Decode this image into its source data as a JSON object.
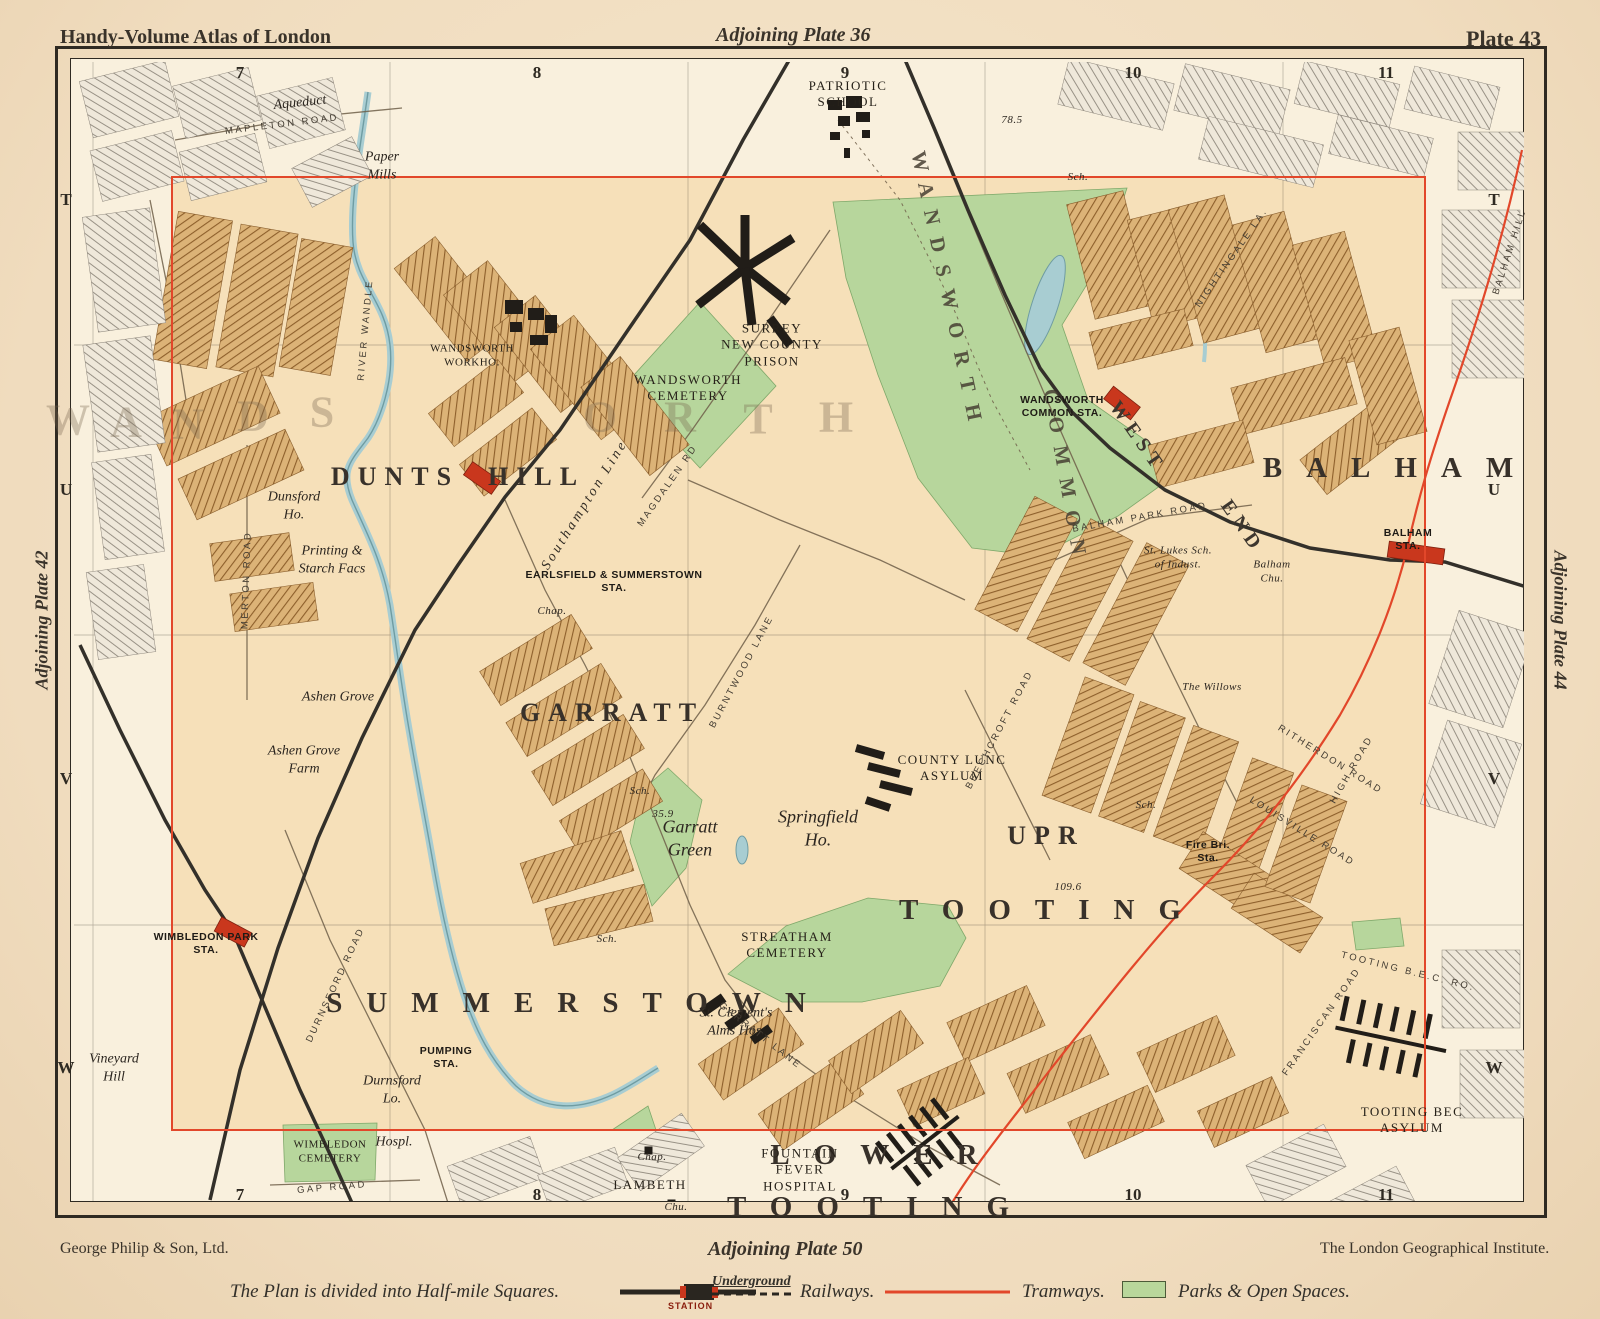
{
  "header": {
    "left": "Handy-Volume Atlas of London",
    "center": "Adjoining Plate 36",
    "right": "Plate 43"
  },
  "margins": {
    "left_vertical": "Adjoining Plate 42",
    "right_vertical": "Adjoining Plate 44",
    "bottom_center": "Adjoining Plate 50"
  },
  "footer": {
    "left": "George Philip & Son, Ltd.",
    "right": "The London Geographical Institute."
  },
  "grid": {
    "columns": [
      "7",
      "8",
      "9",
      "10",
      "11"
    ],
    "rows": [
      "T",
      "U",
      "V",
      "W"
    ]
  },
  "legend": {
    "intro": "The Plan is divided into Half-mile Squares.",
    "station_label": "STATION",
    "underground_label": "Underground",
    "railways_label": "Railways.",
    "tramways_label": "Tramways.",
    "parks_label": "Parks & Open Spaces."
  },
  "colors": {
    "plate_border": "#e2472a",
    "tramway": "#e2472a",
    "railway": "#33302a",
    "park_green": "#b7d69c",
    "water_blue": "#a8cdd2",
    "station_red": "#c9371d",
    "paper": "#f2e0c5"
  },
  "map": {
    "labels": [
      {
        "t": "DUNTS  HILL",
        "x": 458,
        "y": 477,
        "c": "district"
      },
      {
        "t": "GARRATT",
        "x": 612,
        "y": 713,
        "c": "district"
      },
      {
        "t": "SUMMERSTOWN",
        "x": 578,
        "y": 1003,
        "c": "district-wide"
      },
      {
        "t": "UPR",
        "x": 1046,
        "y": 836,
        "c": "district"
      },
      {
        "t": "TOOTING",
        "x": 1052,
        "y": 910,
        "c": "district-wide"
      },
      {
        "t": "LOWER",
        "x": 886,
        "y": 1155,
        "c": "district-wide"
      },
      {
        "t": "TOOTING",
        "x": 880,
        "y": 1207,
        "c": "district-wide"
      },
      {
        "t": "BALHAM",
        "x": 1400,
        "y": 468,
        "c": "district-wide"
      },
      {
        "t": "WEST",
        "x": 1137,
        "y": 437,
        "c": "district-sm",
        "r": 55
      },
      {
        "t": "END",
        "x": 1242,
        "y": 527,
        "c": "district-sm",
        "r": 55
      },
      {
        "t": "WANDSWORTH",
        "x": 948,
        "y": 292,
        "c": "rail-name",
        "r": 78
      },
      {
        "t": "COMMON",
        "x": 1066,
        "y": 478,
        "c": "rail-name",
        "r": 80
      },
      {
        "t": "W",
        "x": 68,
        "y": 420,
        "c": "faint"
      },
      {
        "t": "A",
        "x": 126,
        "y": 422,
        "c": "faint"
      },
      {
        "t": "N",
        "x": 188,
        "y": 424,
        "c": "faint"
      },
      {
        "t": "D",
        "x": 253,
        "y": 416,
        "c": "faint"
      },
      {
        "t": "S",
        "x": 322,
        "y": 412,
        "c": "faint"
      },
      {
        "t": "O",
        "x": 600,
        "y": 417,
        "c": "faint"
      },
      {
        "t": "R",
        "x": 680,
        "y": 417,
        "c": "faint"
      },
      {
        "t": "T",
        "x": 758,
        "y": 419,
        "c": "faint"
      },
      {
        "t": "H",
        "x": 836,
        "y": 417,
        "c": "faint"
      },
      {
        "t": "WANDSWORTH\nCEMETERY",
        "x": 688,
        "y": 388,
        "c": "place"
      },
      {
        "t": "SURREY\nNEW COUNTY\nPRISON",
        "x": 772,
        "y": 345,
        "c": "place"
      },
      {
        "t": "PATRIOTIC\nSCHOOL",
        "x": 848,
        "y": 94,
        "c": "place"
      },
      {
        "t": "COUNTY LUNC\nASYLUM",
        "x": 952,
        "y": 768,
        "c": "place"
      },
      {
        "t": "STREATHAM\nCEMETERY",
        "x": 787,
        "y": 945,
        "c": "place"
      },
      {
        "t": "TOOTING BEC\nASYLUM",
        "x": 1412,
        "y": 1120,
        "c": "place"
      },
      {
        "t": "WIMBLEDON\nCEMETERY",
        "x": 330,
        "y": 1152,
        "c": "place tiny2"
      },
      {
        "t": "FOUNTAIN\nFEVER\nHOSPITAL",
        "x": 800,
        "y": 1170,
        "c": "place"
      },
      {
        "t": "LAMBETH",
        "x": 650,
        "y": 1185,
        "c": "place"
      },
      {
        "t": "WANDSWORTH\nWORKHO.",
        "x": 472,
        "y": 356,
        "c": "place tiny2"
      },
      {
        "t": "St. Lukes Sch.\nof Indust.",
        "x": 1178,
        "y": 558,
        "c": "italic tiny2"
      },
      {
        "t": "Garratt\nGreen",
        "x": 690,
        "y": 838,
        "c": "italic big-it"
      },
      {
        "t": "Springfield\nHo.",
        "x": 818,
        "y": 828,
        "c": "italic big-it"
      },
      {
        "t": "Dunsford\nHo.",
        "x": 294,
        "y": 506,
        "c": "italic"
      },
      {
        "t": "Ashen Grove",
        "x": 338,
        "y": 697,
        "c": "italic"
      },
      {
        "t": "Ashen Grove\nFarm",
        "x": 304,
        "y": 760,
        "c": "italic"
      },
      {
        "t": "Printing &\nStarch Facs",
        "x": 332,
        "y": 560,
        "c": "italic"
      },
      {
        "t": "Durnsford\nLo.",
        "x": 392,
        "y": 1090,
        "c": "italic"
      },
      {
        "t": "Vineyard\nHill",
        "x": 114,
        "y": 1068,
        "c": "italic"
      },
      {
        "t": "Paper\nMills",
        "x": 382,
        "y": 166,
        "c": "italic"
      },
      {
        "t": "Aqueduct",
        "x": 300,
        "y": 103,
        "c": "italic",
        "r": -6
      },
      {
        "t": "Hospl.",
        "x": 394,
        "y": 1142,
        "c": "italic"
      },
      {
        "t": "Chap.",
        "x": 652,
        "y": 1158,
        "c": "italic tiny2"
      },
      {
        "t": "Chu.",
        "x": 676,
        "y": 1208,
        "c": "italic tiny2"
      },
      {
        "t": "Chap.",
        "x": 552,
        "y": 612,
        "c": "italic tiny2"
      },
      {
        "t": "St. Clement's\nAlms Hos.",
        "x": 736,
        "y": 1022,
        "c": "italic"
      },
      {
        "t": "The Willows",
        "x": 1212,
        "y": 688,
        "c": "italic tiny2"
      },
      {
        "t": "Fire Bri.\nSta.",
        "x": 1208,
        "y": 852,
        "c": "station tiny2"
      },
      {
        "t": "Balham\nChu.",
        "x": 1272,
        "y": 572,
        "c": "italic tiny2"
      },
      {
        "t": "109.6",
        "x": 1068,
        "y": 888,
        "c": "italic tiny2"
      },
      {
        "t": "78.5",
        "x": 1012,
        "y": 121,
        "c": "italic tiny2"
      },
      {
        "t": "35.9",
        "x": 663,
        "y": 815,
        "c": "italic tiny2"
      },
      {
        "t": "Sch.",
        "x": 640,
        "y": 792,
        "c": "italic tiny2"
      },
      {
        "t": "Sch.",
        "x": 607,
        "y": 940,
        "c": "italic tiny2"
      },
      {
        "t": "Sch.",
        "x": 1078,
        "y": 178,
        "c": "italic tiny2"
      },
      {
        "t": "Sch.",
        "x": 1146,
        "y": 806,
        "c": "italic tiny2"
      },
      {
        "t": "EARLSFIELD & SUMMERSTOWN\nSTA.",
        "x": 614,
        "y": 582,
        "c": "station"
      },
      {
        "t": "WANDSWORTH\nCOMMON STA.",
        "x": 1062,
        "y": 407,
        "c": "station"
      },
      {
        "t": "BALHAM\nSTA.",
        "x": 1408,
        "y": 540,
        "c": "station"
      },
      {
        "t": "WIMBLEDON PARK\nSTA.",
        "x": 206,
        "y": 944,
        "c": "station"
      },
      {
        "t": "PUMPING\nSTA.",
        "x": 446,
        "y": 1058,
        "c": "station"
      },
      {
        "t": "Southampton Line",
        "x": 585,
        "y": 505,
        "c": "rail-label",
        "r": -58
      },
      {
        "t": "RIVER WANDLE",
        "x": 366,
        "y": 330,
        "c": "road",
        "r": -85
      },
      {
        "t": "BURNTWOOD LANE",
        "x": 742,
        "y": 672,
        "c": "road",
        "r": -62
      },
      {
        "t": "GARRATT LANE",
        "x": 760,
        "y": 1036,
        "c": "road",
        "r": 38
      },
      {
        "t": "MERTON ROAD",
        "x": 247,
        "y": 580,
        "c": "road",
        "r": -88
      },
      {
        "t": "DURNSFORD ROAD",
        "x": 336,
        "y": 985,
        "c": "road",
        "r": -65
      },
      {
        "t": "GAP ROAD",
        "x": 332,
        "y": 1188,
        "c": "road",
        "r": -5
      },
      {
        "t": "BALHAM HILL",
        "x": 1510,
        "y": 252,
        "c": "road",
        "r": -72
      },
      {
        "t": "HIGH ROAD",
        "x": 1352,
        "y": 770,
        "c": "road",
        "r": -60
      },
      {
        "t": "TOOTING B.E.C. RO.",
        "x": 1408,
        "y": 972,
        "c": "road",
        "r": 14
      },
      {
        "t": "BALHAM PARK ROAD",
        "x": 1140,
        "y": 518,
        "c": "road",
        "r": -10
      },
      {
        "t": "MAPLETON ROAD",
        "x": 282,
        "y": 125,
        "c": "road",
        "r": -7
      },
      {
        "t": "MAGDALEN RD",
        "x": 668,
        "y": 486,
        "c": "road",
        "r": -55
      },
      {
        "t": "NIGHTINGALE LA.",
        "x": 1232,
        "y": 258,
        "c": "road",
        "r": -55
      },
      {
        "t": "RITHERDON ROAD",
        "x": 1330,
        "y": 760,
        "c": "road",
        "r": 32
      },
      {
        "t": "LOUISVILLE ROAD",
        "x": 1302,
        "y": 832,
        "c": "road",
        "r": 32
      },
      {
        "t": "FRANCISCAN ROAD",
        "x": 1322,
        "y": 1022,
        "c": "road",
        "r": -55
      },
      {
        "t": "BEECHCROFT ROAD",
        "x": 1000,
        "y": 730,
        "c": "road",
        "r": -62
      }
    ]
  }
}
